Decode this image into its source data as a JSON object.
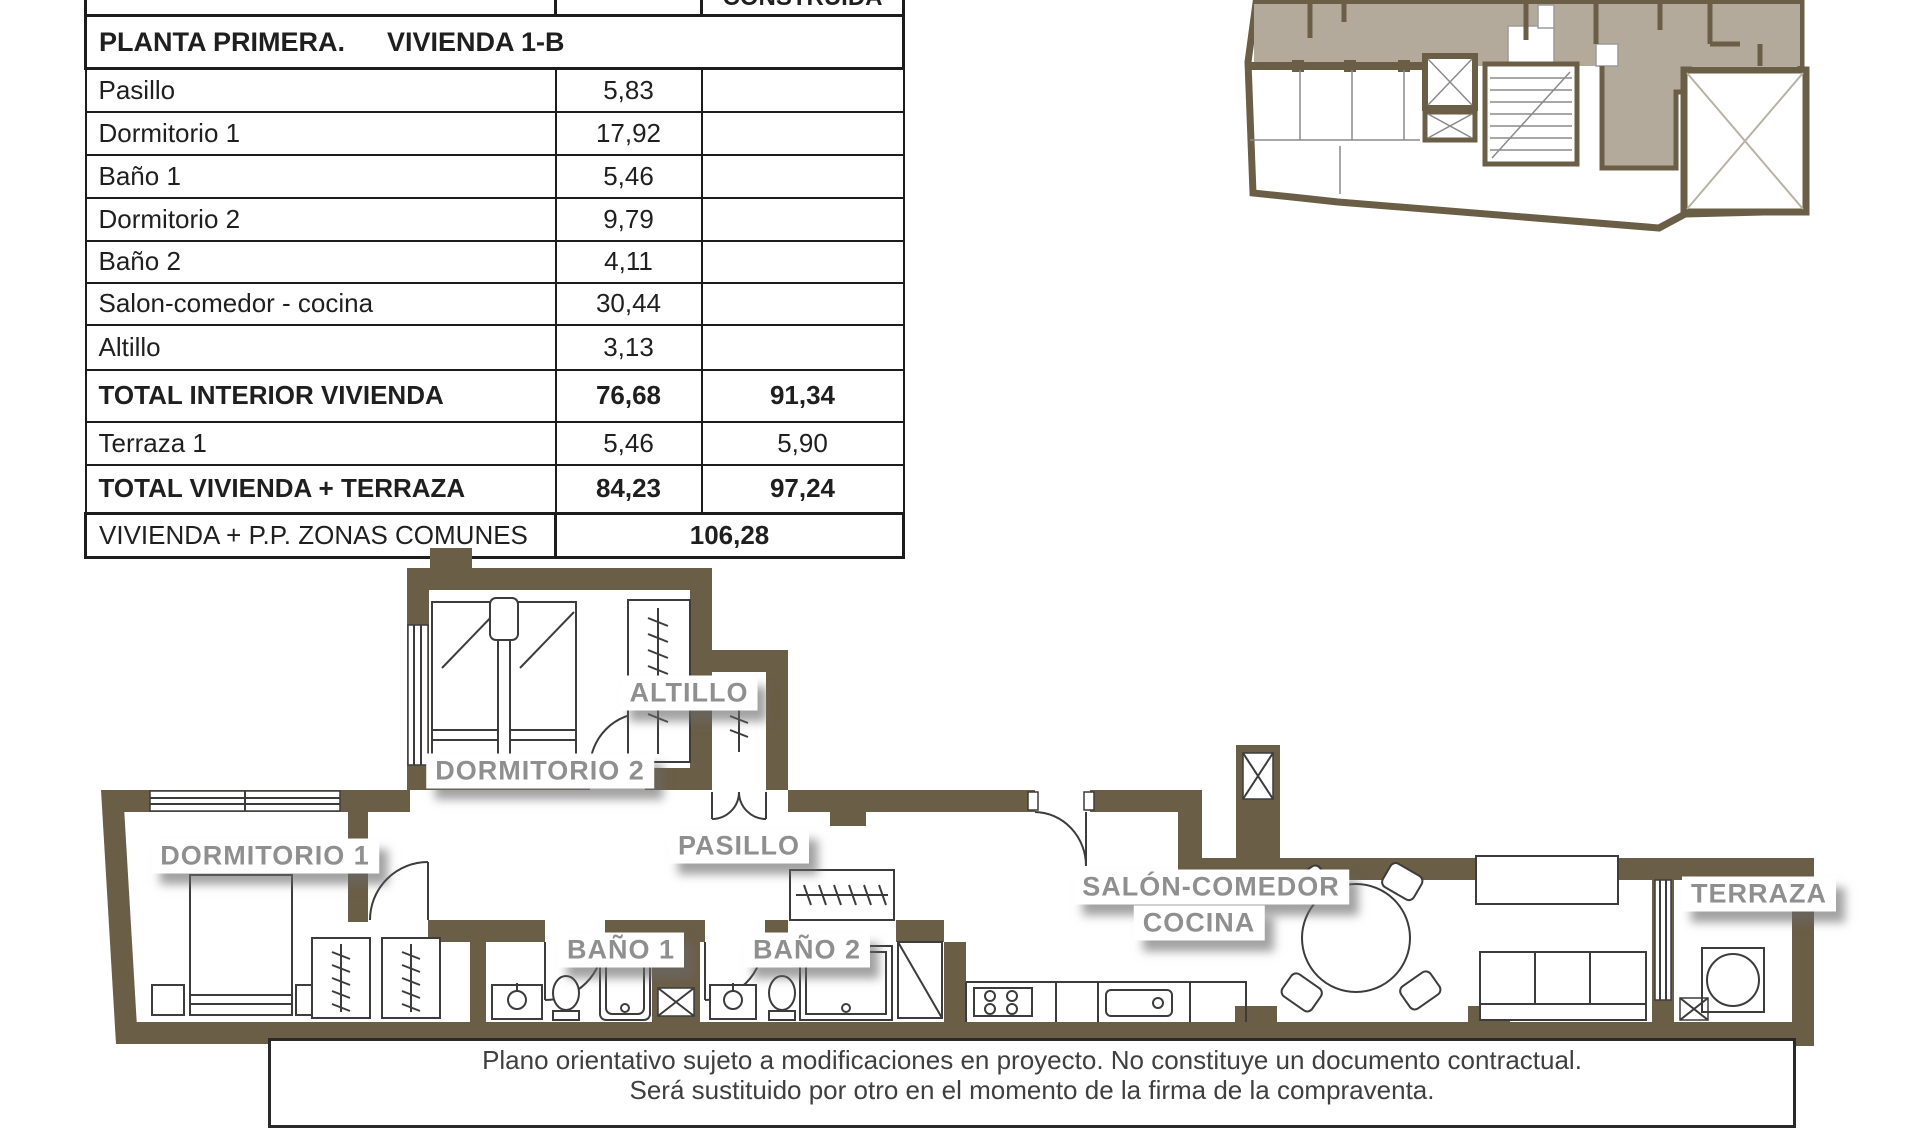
{
  "table": {
    "header": {
      "construida": "CONSTRUIDA"
    },
    "section": {
      "floor": "PLANTA PRIMERA.",
      "unit": "VIVIENDA 1-B"
    },
    "rows": [
      {
        "label": "Pasillo",
        "util": "5,83",
        "construida": ""
      },
      {
        "label": "Dormitorio 1",
        "util": "17,92",
        "construida": ""
      },
      {
        "label": "Baño 1",
        "util": "5,46",
        "construida": ""
      },
      {
        "label": "Dormitorio 2",
        "util": "9,79",
        "construida": ""
      },
      {
        "label": "Baño 2",
        "util": "4,11",
        "construida": ""
      },
      {
        "label": "Salon-comedor - cocina",
        "util": "30,44",
        "construida": ""
      },
      {
        "label": "Altillo",
        "util": "3,13",
        "construida": ""
      },
      {
        "label": "TOTAL INTERIOR VIVIENDA",
        "util": "76,68",
        "construida": "91,34"
      },
      {
        "label": "Terraza 1",
        "util": "5,46",
        "construida": "5,90"
      },
      {
        "label": "TOTAL VIVIENDA + TERRAZA",
        "util": "84,23",
        "construida": "97,24"
      }
    ],
    "footer": {
      "label": "VIVIENDA + P.P. ZONAS COMUNES",
      "value": "106,28"
    }
  },
  "plan": {
    "labels": {
      "dormitorio1": "DORMITORIO 1",
      "dormitorio2": "DORMITORIO 2",
      "altillo": "ALTILLO",
      "pasillo": "PASILLO",
      "bano1": "BAÑO 1",
      "bano2": "BAÑO 2",
      "salon_line1": "SALÓN-COMEDOR",
      "salon_line2": "COCINA",
      "terraza": "TERRAZA"
    }
  },
  "disclaimer": {
    "line1": "Plano orientativo sujeto a modificaciones en proyecto. No constituye un documento contractual.",
    "line2": "Será sustituido por otro en el momento de la firma de la compraventa."
  },
  "colors": {
    "wall_brown": "#6b5e47",
    "unit_highlight_taupe": "#b4aa9b",
    "label_text_gray": "#8f8f8f",
    "table_border": "#1c1c1c"
  }
}
